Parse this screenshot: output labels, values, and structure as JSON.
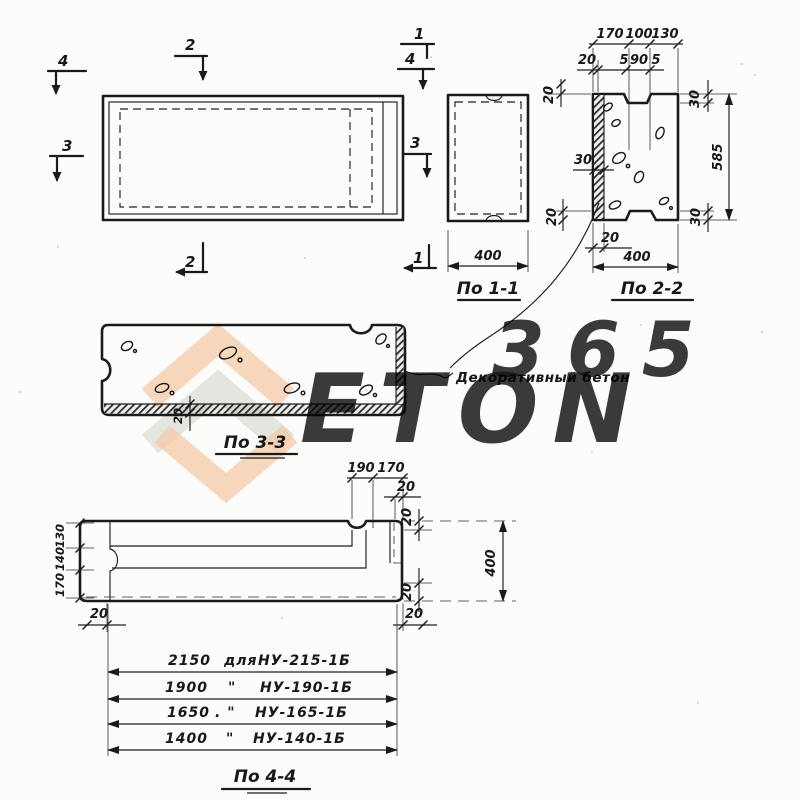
{
  "watermark": {
    "number": "365",
    "word": "ETON"
  },
  "annotation": "Декоративный бетон",
  "plan": {
    "mark_4_tl": "4",
    "mark_2_top": "2",
    "mark_1_tr": "1",
    "mark_4_tr": "4",
    "mark_3_left": "3",
    "mark_3_right": "3",
    "mark_2_bottom": "2",
    "mark_1_br": "1"
  },
  "sec11": {
    "label": "По 1-1",
    "width": "400"
  },
  "sec22": {
    "label": "По 2-2",
    "top_row1": [
      "170",
      "100",
      "130"
    ],
    "top_row2": [
      "20",
      "5",
      "90",
      "5"
    ],
    "left_top": "20",
    "left_mid": "30",
    "left_bottom": "20",
    "below_left": "20",
    "right_top": "30",
    "right_total": "585",
    "right_bottom": "30",
    "bottom": "400"
  },
  "sec33": {
    "label": "По 3-3",
    "layer": "20"
  },
  "sec44": {
    "label": "По 4-4",
    "top": [
      "190",
      "170"
    ],
    "top_offset": "20",
    "right_upper": "20",
    "right_total": "400",
    "right_lower": "20",
    "bottom_right": "20",
    "bottom_left": "20",
    "left": [
      "130",
      "140",
      "170"
    ],
    "rows": [
      {
        "length": "2150",
        "conj": "для",
        "mark": "НУ-215-1Б"
      },
      {
        "length": "1900",
        "conj": "\"",
        "mark": "НУ-190-1Б"
      },
      {
        "length": "1650",
        "conj": ". \"",
        "mark": "НУ-165-1Б"
      },
      {
        "length": "1400",
        "conj": "\"",
        "mark": "НУ-140-1Б"
      }
    ]
  }
}
